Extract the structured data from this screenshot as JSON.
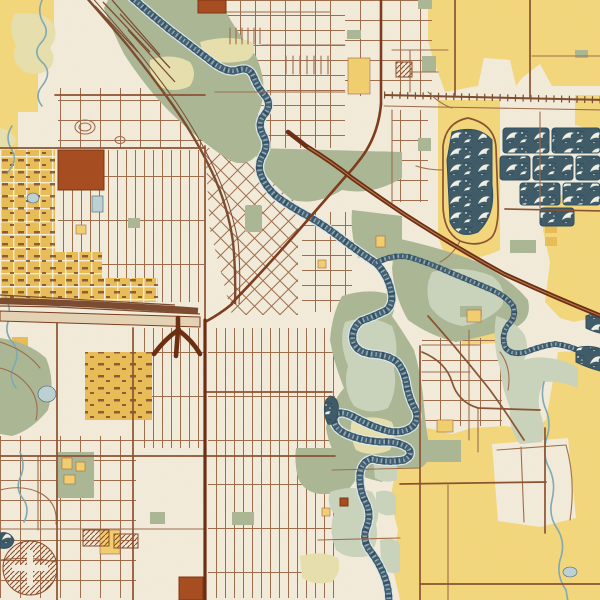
{
  "map": {
    "kind": "vintage-style city street map poster",
    "description": "hand-drawn style map with meandering river, wave-textured quarry ponds, rail corridors, street grids; no text labels visible",
    "width_px": 600,
    "height_px": 600
  },
  "colors": {
    "paper": "#f3ecdb",
    "field": "#f4d77c",
    "commercial": "#e9bd56",
    "schoolYellow": "#f2cf6e",
    "park": "#abb794",
    "parkLight": "#cad3bc",
    "marsh": "#e7e0ad",
    "pond": "#bdd2d5",
    "creek": "#7fa9b6",
    "riverDark": "#3f6077",
    "riverDeep": "#2e4d60",
    "riverLight": "#dfe9ec",
    "waterWave": "#3d5a67",
    "waveCrest": "#f2f0e4",
    "roadMinor": "#9d6c4b",
    "roadMid": "#8a5130",
    "roadMajor": "#7c3a1b",
    "highway": "#6b2c10",
    "highwayFill": "#e4d4b5",
    "rail": "#7b4a2e",
    "rust": "#a64b1f",
    "rustDark": "#7e340f",
    "creamRoad": "#f6efdc"
  },
  "features": {
    "water": [
      "meandering-river",
      "river-east-branch",
      "wave-pattern-quarry-ponds",
      "small-creeks",
      "ponds"
    ],
    "transport": [
      "diagonal-freeway",
      "highway-corridor-west",
      "trident-interchange",
      "railroad-diagonal-nw",
      "railroad-northeast",
      "rail-yard",
      "street-grids",
      "racetrack-oval"
    ],
    "landuse": [
      "farm-fields-yellow",
      "industrial-district-amber",
      "riverside-parks-sage",
      "marsh-patches",
      "school-blocks",
      "rust-building-blocks",
      "hatched-complex"
    ]
  }
}
